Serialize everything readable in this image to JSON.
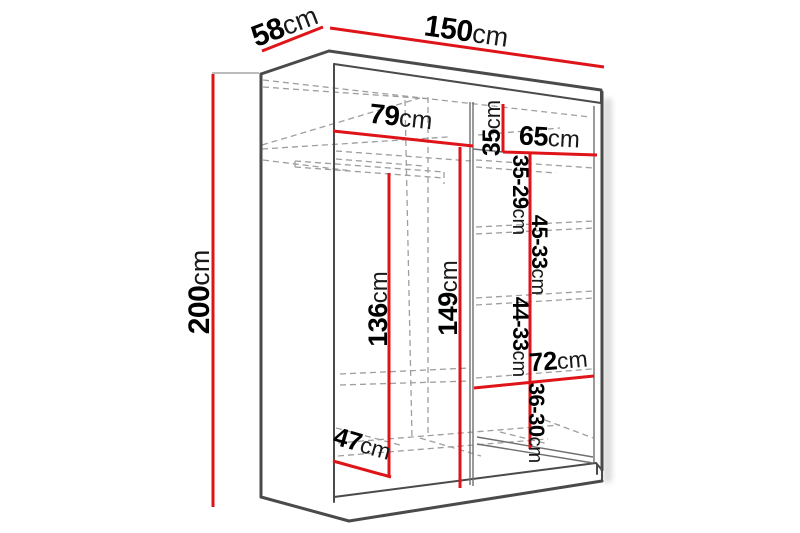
{
  "diagram": {
    "type": "wardrobe-dimensions",
    "unit": "cm",
    "colors": {
      "dimension_line": "#de1418",
      "outline": "#4a4a4a",
      "hidden_line": "#9e9e9e",
      "background": "#ffffff",
      "text": "#000000"
    },
    "labels": {
      "height": {
        "num": "200",
        "unit": "cm"
      },
      "depth": {
        "num": "58",
        "unit": "cm"
      },
      "width": {
        "num": "150",
        "unit": "cm"
      },
      "left_width": {
        "num": "79",
        "unit": "cm"
      },
      "top_gap": {
        "num": "35",
        "unit": "cm"
      },
      "right_width": {
        "num": "65",
        "unit": "cm"
      },
      "hanging_height": {
        "num": "136",
        "unit": "cm"
      },
      "left_height": {
        "num": "149",
        "unit": "cm"
      },
      "shelf_gap_1": {
        "num": "35-29",
        "unit": "cm"
      },
      "shelf_gap_2": {
        "num": "45-33",
        "unit": "cm"
      },
      "shelf_gap_3": {
        "num": "44-33",
        "unit": "cm"
      },
      "lower_shelf_width": {
        "num": "72",
        "unit": "cm"
      },
      "shelf_gap_4": {
        "num": "36-30",
        "unit": "cm"
      },
      "floor_depth": {
        "num": "47",
        "unit": "cm"
      }
    }
  }
}
